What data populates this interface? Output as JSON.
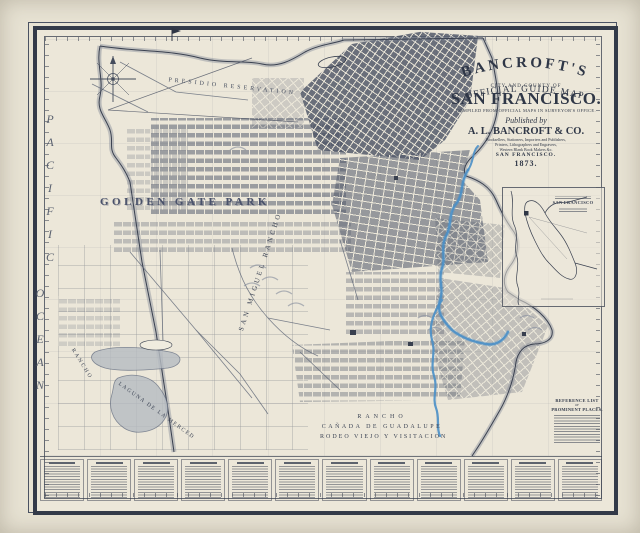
{
  "map": {
    "title_block": {
      "brand": "BANCROFT'S",
      "subtitle": "OFFICIAL GUIDE MAP",
      "of_line": "CITY AND COUNTY OF",
      "city_title": "SAN FRANCISCO.",
      "compiled": "COMPILED FROM OFFICIAL MAPS IN SURVEYOR'S OFFICE.",
      "published_by": "Published by",
      "publisher": "A. L. BANCROFT & CO.",
      "publisher_line1": "Booksellers, Stationers, Importers and Publishers,",
      "publisher_line2": "Printers, Lithographers and Engravers,",
      "publisher_line3": "Western Blank Book Makers &c.",
      "publisher_city": "SAN FRANCISCO.",
      "year": "1873."
    },
    "labels": {
      "pacific": "PACIFIC",
      "ocean": "OCEAN",
      "presidio": "PRESIDIO RESERVATION",
      "golden_gate_park": "GOLDEN GATE PARK",
      "san_miguel": "SAN MIGUEL RANCHO",
      "laguna_merced": "LAGUNA DE LA MERCED",
      "rancho_west": "RANCHO",
      "rancho_line1": "RANCHO",
      "rancho_line2": "CAÑADA DE GUADALUPE",
      "rancho_line3": "RODEO VIEJO Y VISITACION"
    },
    "inset": {
      "title": "SAN FRANCISCO"
    },
    "reference_list": {
      "line1": "REFERENCE LIST",
      "line2": "OF",
      "line3": "PROMINENT PLACES."
    },
    "colors": {
      "paper": "#e7e2d3",
      "map_field": "#ece7d9",
      "ink": "#3a4150",
      "water_blue": "#4a8fc7",
      "shade_gray": "#7c8494"
    }
  }
}
